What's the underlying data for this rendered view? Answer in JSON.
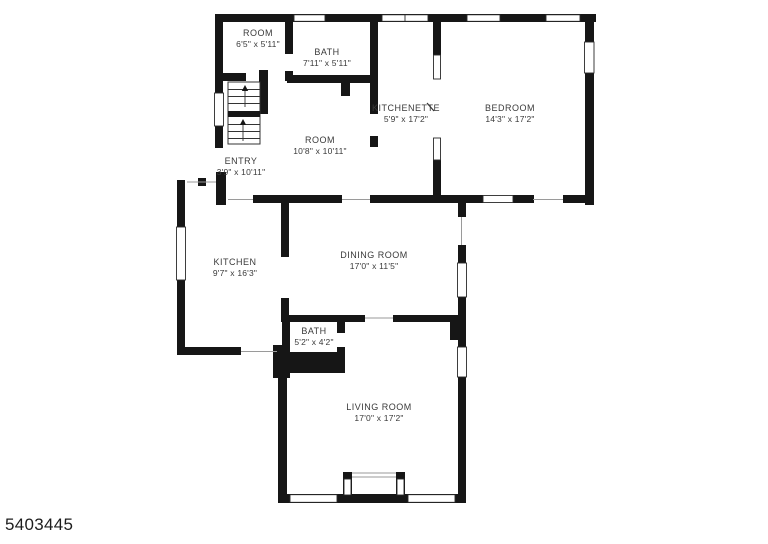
{
  "plan": {
    "listing_id": "5403445",
    "colors": {
      "wall": "#161616",
      "text": "#3a3a3a",
      "background": "#ffffff"
    },
    "rooms": [
      {
        "name": "ROOM",
        "dims": "6'5\" x 5'11\"",
        "cx": 258,
        "cy": 33
      },
      {
        "name": "BATH",
        "dims": "7'11\" x 5'11\"",
        "cx": 327,
        "cy": 52
      },
      {
        "name": "KITCHENETTE",
        "dims": "5'9\" x 17'2\"",
        "cx": 406,
        "cy": 108
      },
      {
        "name": "BEDROOM",
        "dims": "14'3\" x 17'2\"",
        "cx": 510,
        "cy": 108
      },
      {
        "name": "ROOM",
        "dims": "10'8\" x 10'11\"",
        "cx": 320,
        "cy": 140
      },
      {
        "name": "ENTRY",
        "dims": "3'9\" x 10'11\"",
        "cx": 241,
        "cy": 161
      },
      {
        "name": "KITCHEN",
        "dims": "9'7\" x 16'3\"",
        "cx": 235,
        "cy": 262
      },
      {
        "name": "DINING ROOM",
        "dims": "17'0\" x 11'5\"",
        "cx": 374,
        "cy": 255
      },
      {
        "name": "BATH",
        "dims": "5'2\" x 4'2\"",
        "cx": 314,
        "cy": 331
      },
      {
        "name": "LIVING ROOM",
        "dims": "17'0\" x 17'2\"",
        "cx": 379,
        "cy": 407
      }
    ]
  }
}
